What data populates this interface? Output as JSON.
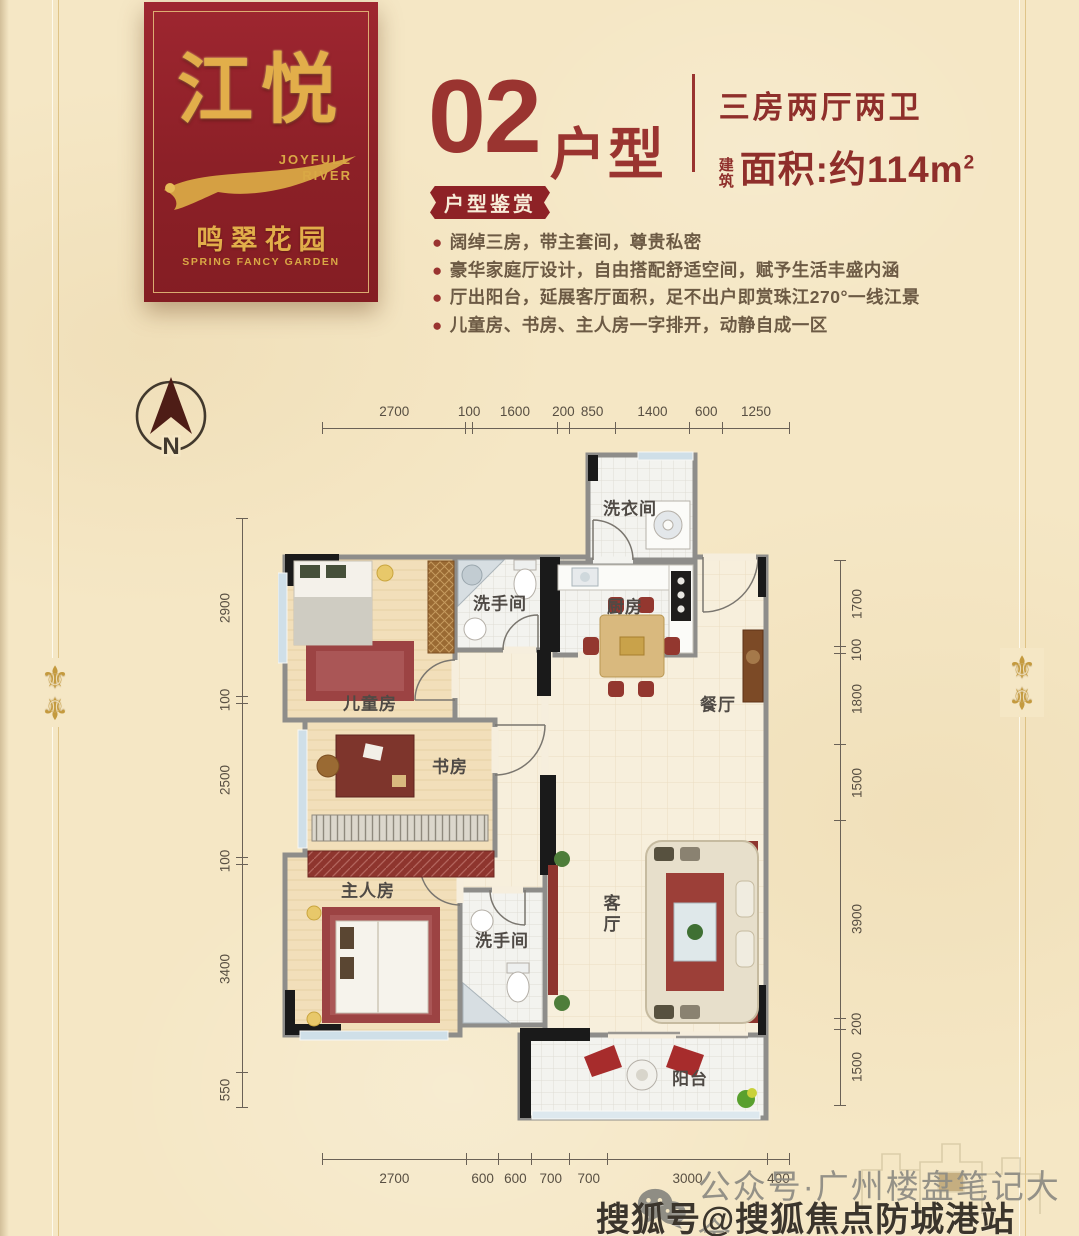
{
  "brand_card": {
    "name": "江悦",
    "name_en_line1": "JOYFULL",
    "name_en_line2": "RIVER",
    "garden_name": "鸣翠花园",
    "garden_en": "SPRING FANCY GARDEN"
  },
  "header": {
    "unit_number": "02",
    "unit_label": "户型",
    "layout": "三房两厅两卫",
    "area_prefix": "建筑",
    "area_text": "面积:约114m",
    "area_sup": "2",
    "badge": "户型鉴赏"
  },
  "features": [
    "阔绰三房，带主套间，尊贵私密",
    "豪华家庭厅设计，自由搭配舒适空间，赋予生活丰盛内涵",
    "厅出阳台，延展客厅面积，足不出户即赏珠江270°一线江景",
    "儿童房、书房、主人房一字排开，动静自成一区"
  ],
  "compass": {
    "label": "N"
  },
  "rooms": {
    "laundry": "洗衣间",
    "bath1": "洗手间",
    "kitchen": "厨房",
    "dining": "餐厅",
    "children": "儿童房",
    "study": "书房",
    "master": "主人房",
    "bath2": "洗手间",
    "living": "客厅",
    "balcony": "阳台"
  },
  "dimensions": {
    "top": [
      2700,
      100,
      1600,
      200,
      850,
      1400,
      600,
      1250
    ],
    "bottom": [
      2700,
      600,
      600,
      700,
      700,
      3000,
      400
    ],
    "left": [
      2900,
      100,
      2500,
      100,
      3400,
      550
    ],
    "right": [
      1700,
      100,
      1800,
      1500,
      3900,
      200,
      1500
    ]
  },
  "watermarks": {
    "wechat": "公众号·广州楼盘笔记大全",
    "sohu": "搜狐号@搜狐焦点防城港站"
  },
  "colors": {
    "card_red": "#93232B",
    "gold": "#D9A845",
    "title_red": "#9A3430",
    "text_brown": "#6C5A44",
    "wall_gray": "#8E8D8A",
    "dim_text": "#584F42"
  }
}
